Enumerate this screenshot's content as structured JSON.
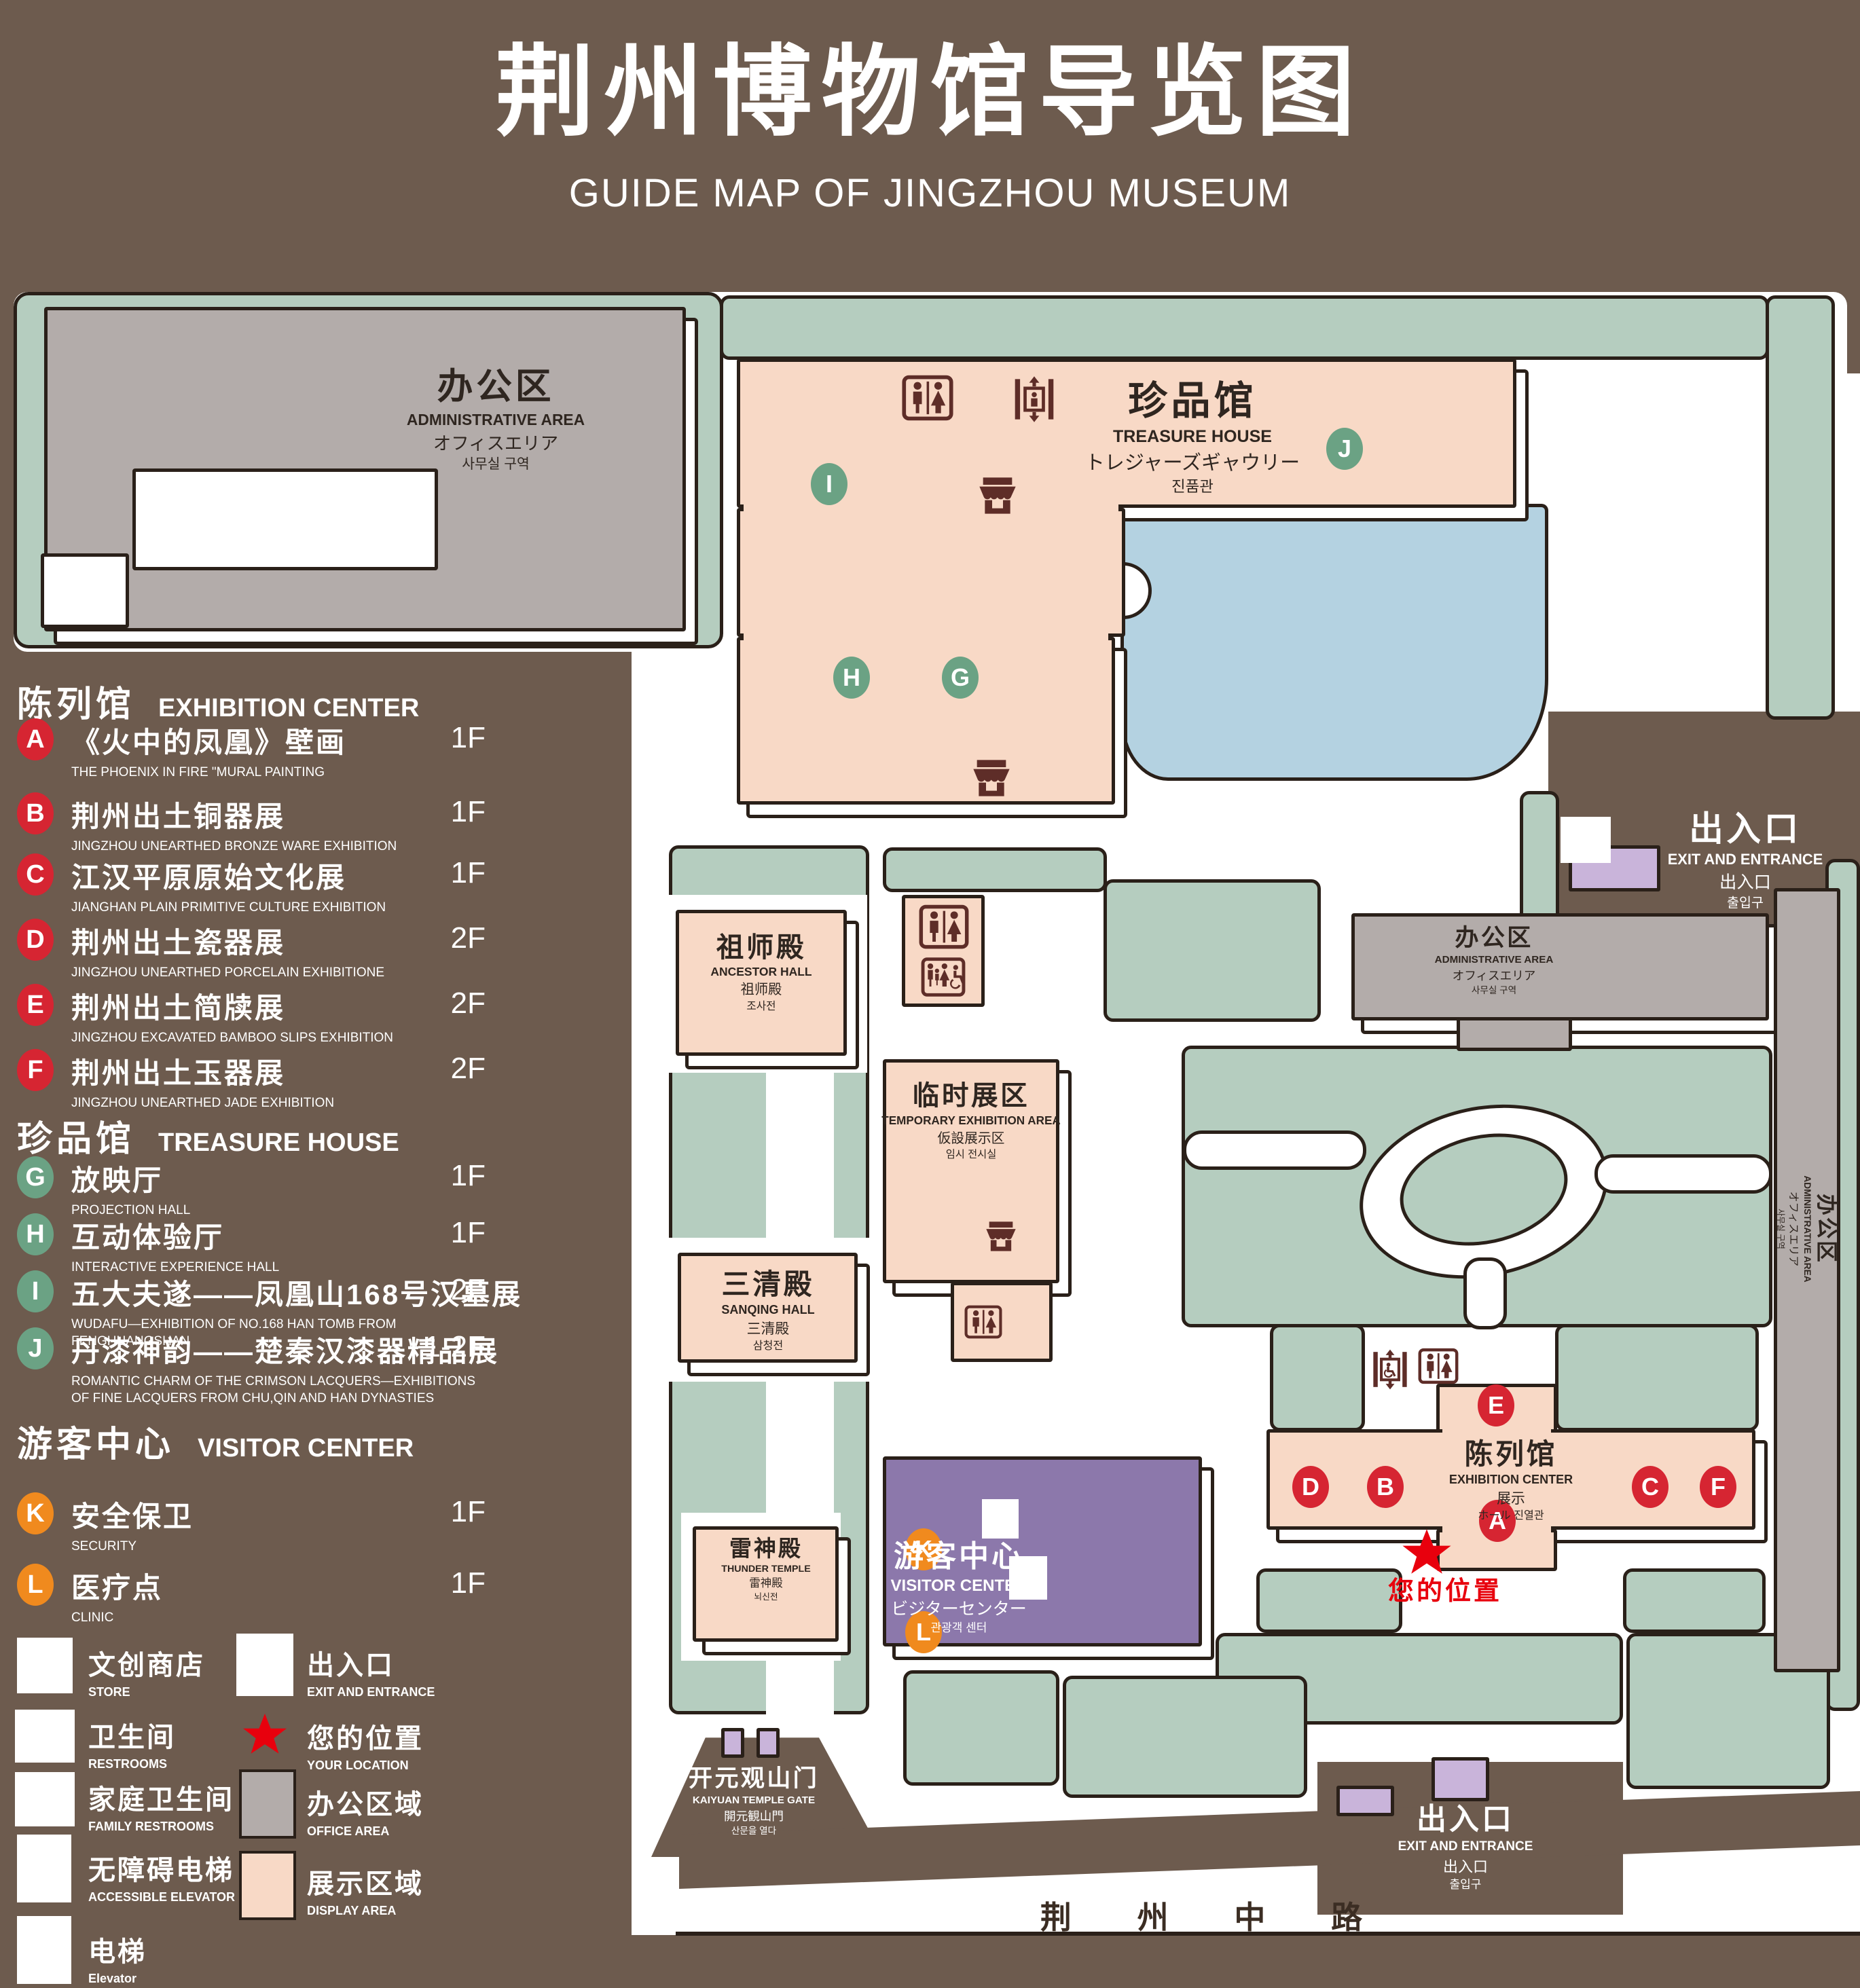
{
  "title": {
    "zh": "荆州博物馆导览图",
    "en": "GUIDE MAP OF JINGZHOU MUSEUM"
  },
  "legend": {
    "sections": [
      {
        "zh": "陈列馆",
        "en": "EXHIBITION CENTER",
        "items": [
          {
            "key": "A",
            "zh": "《火中的凤凰》壁画",
            "en": "THE PHOENIX IN FIRE \"MURAL PAINTING",
            "floor": "1F"
          },
          {
            "key": "B",
            "zh": "荆州出土铜器展",
            "en": "JINGZHOU UNEARTHED BRONZE WARE EXHIBITION",
            "floor": "1F"
          },
          {
            "key": "C",
            "zh": "江汉平原原始文化展",
            "en": "JIANGHAN PLAIN PRIMITIVE CULTURE EXHIBITION",
            "floor": "1F"
          },
          {
            "key": "D",
            "zh": "荆州出土瓷器展",
            "en": "JINGZHOU UNEARTHED PORCELAIN EXHIBITIONE",
            "floor": "2F"
          },
          {
            "key": "E",
            "zh": "荆州出土简牍展",
            "en": "JINGZHOU EXCAVATED BAMBOO SLIPS EXHIBITION",
            "floor": "2F"
          },
          {
            "key": "F",
            "zh": "荆州出土玉器展",
            "en": "JINGZHOU UNEARTHED JADE EXHIBITION",
            "floor": "2F"
          }
        ]
      },
      {
        "zh": "珍品馆",
        "en": "TREASURE HOUSE",
        "items": [
          {
            "key": "G",
            "zh": "放映厅",
            "en": "PROJECTION HALL",
            "floor": "1F"
          },
          {
            "key": "H",
            "zh": "互动体验厅",
            "en": "INTERACTIVE EXPERIENCE HALL",
            "floor": "1F"
          },
          {
            "key": "I",
            "zh": "五大夫遂——凤凰山168号汉墓展",
            "en": "WUDAFU—EXHIBITION OF NO.168 HAN TOMB FROM FENGHUANGSHAN",
            "floor": "2F"
          },
          {
            "key": "J",
            "zh": "丹漆神韵——楚秦汉漆器精品展",
            "en": "ROMANTIC CHARM OF THE CRIMSON LACQUERS—EXHIBITIONS OF FINE LACQUERS FROM CHU,QIN AND HAN DYNASTIES",
            "floor": "1-2F"
          }
        ]
      },
      {
        "zh": "游客中心",
        "en": "VISITOR CENTER",
        "items": [
          {
            "key": "K",
            "zh": "安全保卫",
            "en": "SECURITY",
            "floor": "1F"
          },
          {
            "key": "L",
            "zh": "医疗点",
            "en": "CLINIC",
            "floor": "1F"
          }
        ]
      }
    ],
    "symbols": [
      {
        "icon": "store-icon",
        "zh": "文创商店",
        "en": "STORE"
      },
      {
        "icon": "exit-icon",
        "zh": "出入口",
        "en": "EXIT AND ENTRANCE"
      },
      {
        "icon": "restroom-icon",
        "zh": "卫生间",
        "en": "RESTROOMS"
      },
      {
        "icon": "location-star-icon",
        "zh": "您的位置",
        "en": "YOUR LOCATION"
      },
      {
        "icon": "family-restroom-icon",
        "zh": "家庭卫生间",
        "en": "FAMILY RESTROOMS"
      },
      {
        "icon": "office-area-swatch",
        "zh": "办公区域",
        "en": "OFFICE AREA"
      },
      {
        "icon": "accessible-elevator-icon",
        "zh": "无障碍电梯",
        "en": "ACCESSIBLE ELEVATOR"
      },
      {
        "icon": "display-area-swatch",
        "zh": "展示区域",
        "en": "DISPLAY AREA"
      },
      {
        "icon": "elevator-icon",
        "zh": "电梯",
        "en": "Elevator"
      }
    ]
  },
  "map": {
    "buildings": {
      "admin": {
        "zh": "办公区",
        "en": "ADMINISTRATIVE AREA",
        "ja": "オフィスエリア",
        "ko": "사무실 구역"
      },
      "treasure": {
        "zh": "珍品馆",
        "en": "TREASURE HOUSE",
        "ja": "トレジャーズギャウリー",
        "ko": "진품관"
      },
      "ancestor": {
        "zh": "祖师殿",
        "en": "ANCESTOR HALL",
        "ja": "祖师殿",
        "ko": "조사전"
      },
      "temporary": {
        "zh": "临时展区",
        "en": "TEMPORARY EXHIBITION AREA",
        "ja": "仮設展示区",
        "ko": "임시 전시실"
      },
      "sanqing": {
        "zh": "三清殿",
        "en": "SANQING HALL",
        "ja": "三清殿",
        "ko": "삼청전"
      },
      "thunder": {
        "zh": "雷神殿",
        "en": "THUNDER TEMPLE",
        "ja": "雷神殿",
        "ko": "뇌신전"
      },
      "visitor": {
        "zh": "游客中心",
        "en": "VISITOR CENTER",
        "ja": "ビジターセンター",
        "ko": "관광객 센터"
      },
      "exhibition": {
        "zh": "陈列馆",
        "en": "EXHIBITION CENTER",
        "ja": "展示",
        "ko": "ホール 진열관"
      },
      "gate": {
        "zh": "开元观山门",
        "en": "KAIYUAN TEMPLE GATE",
        "ja": "開元観山門",
        "ko": "산문을 열다"
      },
      "exit": {
        "zh": "出入口",
        "en": "EXIT AND ENTRANCE",
        "ja": "出入口",
        "ko": "출입구"
      }
    },
    "your_location": "您的位置",
    "road": "荆 州 中 路"
  },
  "colors": {
    "background": "#6d5b4e",
    "line": "#2a2019",
    "lawn": "#b5cdbf",
    "display_area": "#f8d9c6",
    "office_area": "#b3acaa",
    "lake": "#b4d2e1",
    "misc_purple": "#c9b4da",
    "visitor_purple": "#8c78ab",
    "badge_red": "#d62532",
    "badge_green": "#6ba284",
    "badge_orange": "#f08a1e",
    "maroon": "#5e2d28",
    "star_red": "#e8000d",
    "text_dark": "#2f2620",
    "road_text": "#3b2d23"
  }
}
